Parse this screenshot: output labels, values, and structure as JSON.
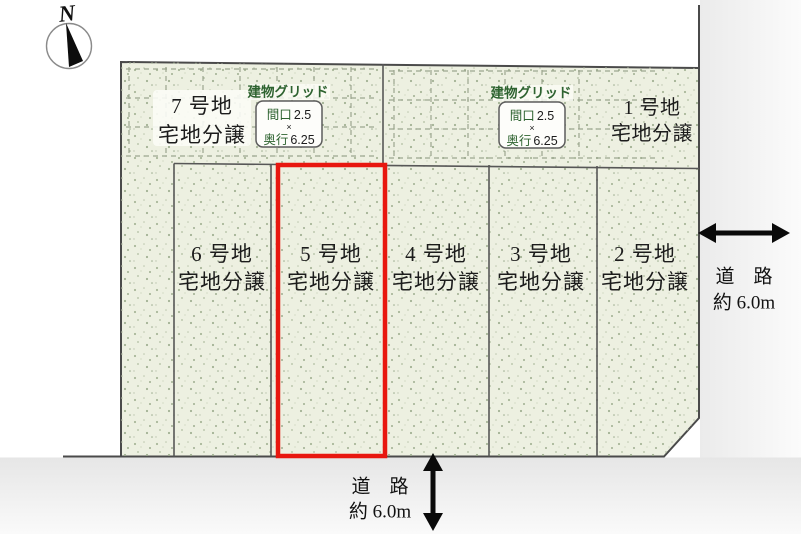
{
  "compass": {
    "north_label": "N"
  },
  "site": {
    "plots": [
      {
        "name": "1 号地",
        "type": "宅地分譲"
      },
      {
        "name": "2 号地",
        "type": "宅地分譲"
      },
      {
        "name": "3 号地",
        "type": "宅地分譲"
      },
      {
        "name": "4 号地",
        "type": "宅地分譲"
      },
      {
        "name": "5 号地",
        "type": "宅地分譲",
        "highlighted": true
      },
      {
        "name": "6 号地",
        "type": "宅地分譲"
      },
      {
        "name": "7 号地",
        "type": "宅地分譲"
      }
    ]
  },
  "building_grid": {
    "title": "建物グリッド",
    "frontage_label": "間口",
    "frontage_value": "2.5",
    "times": "×",
    "depth_label": "奥行",
    "depth_value": "6.25"
  },
  "roads": {
    "east": {
      "name": "道　路",
      "width_label": "約 6.0m"
    },
    "south": {
      "name": "道　路",
      "width_label": "約 6.0m"
    }
  },
  "colors": {
    "plot_fill": "#edf0e1",
    "highlight": "#e8170f",
    "grid_label_green": "#2e6330",
    "boundary": "#4a4a4a"
  }
}
